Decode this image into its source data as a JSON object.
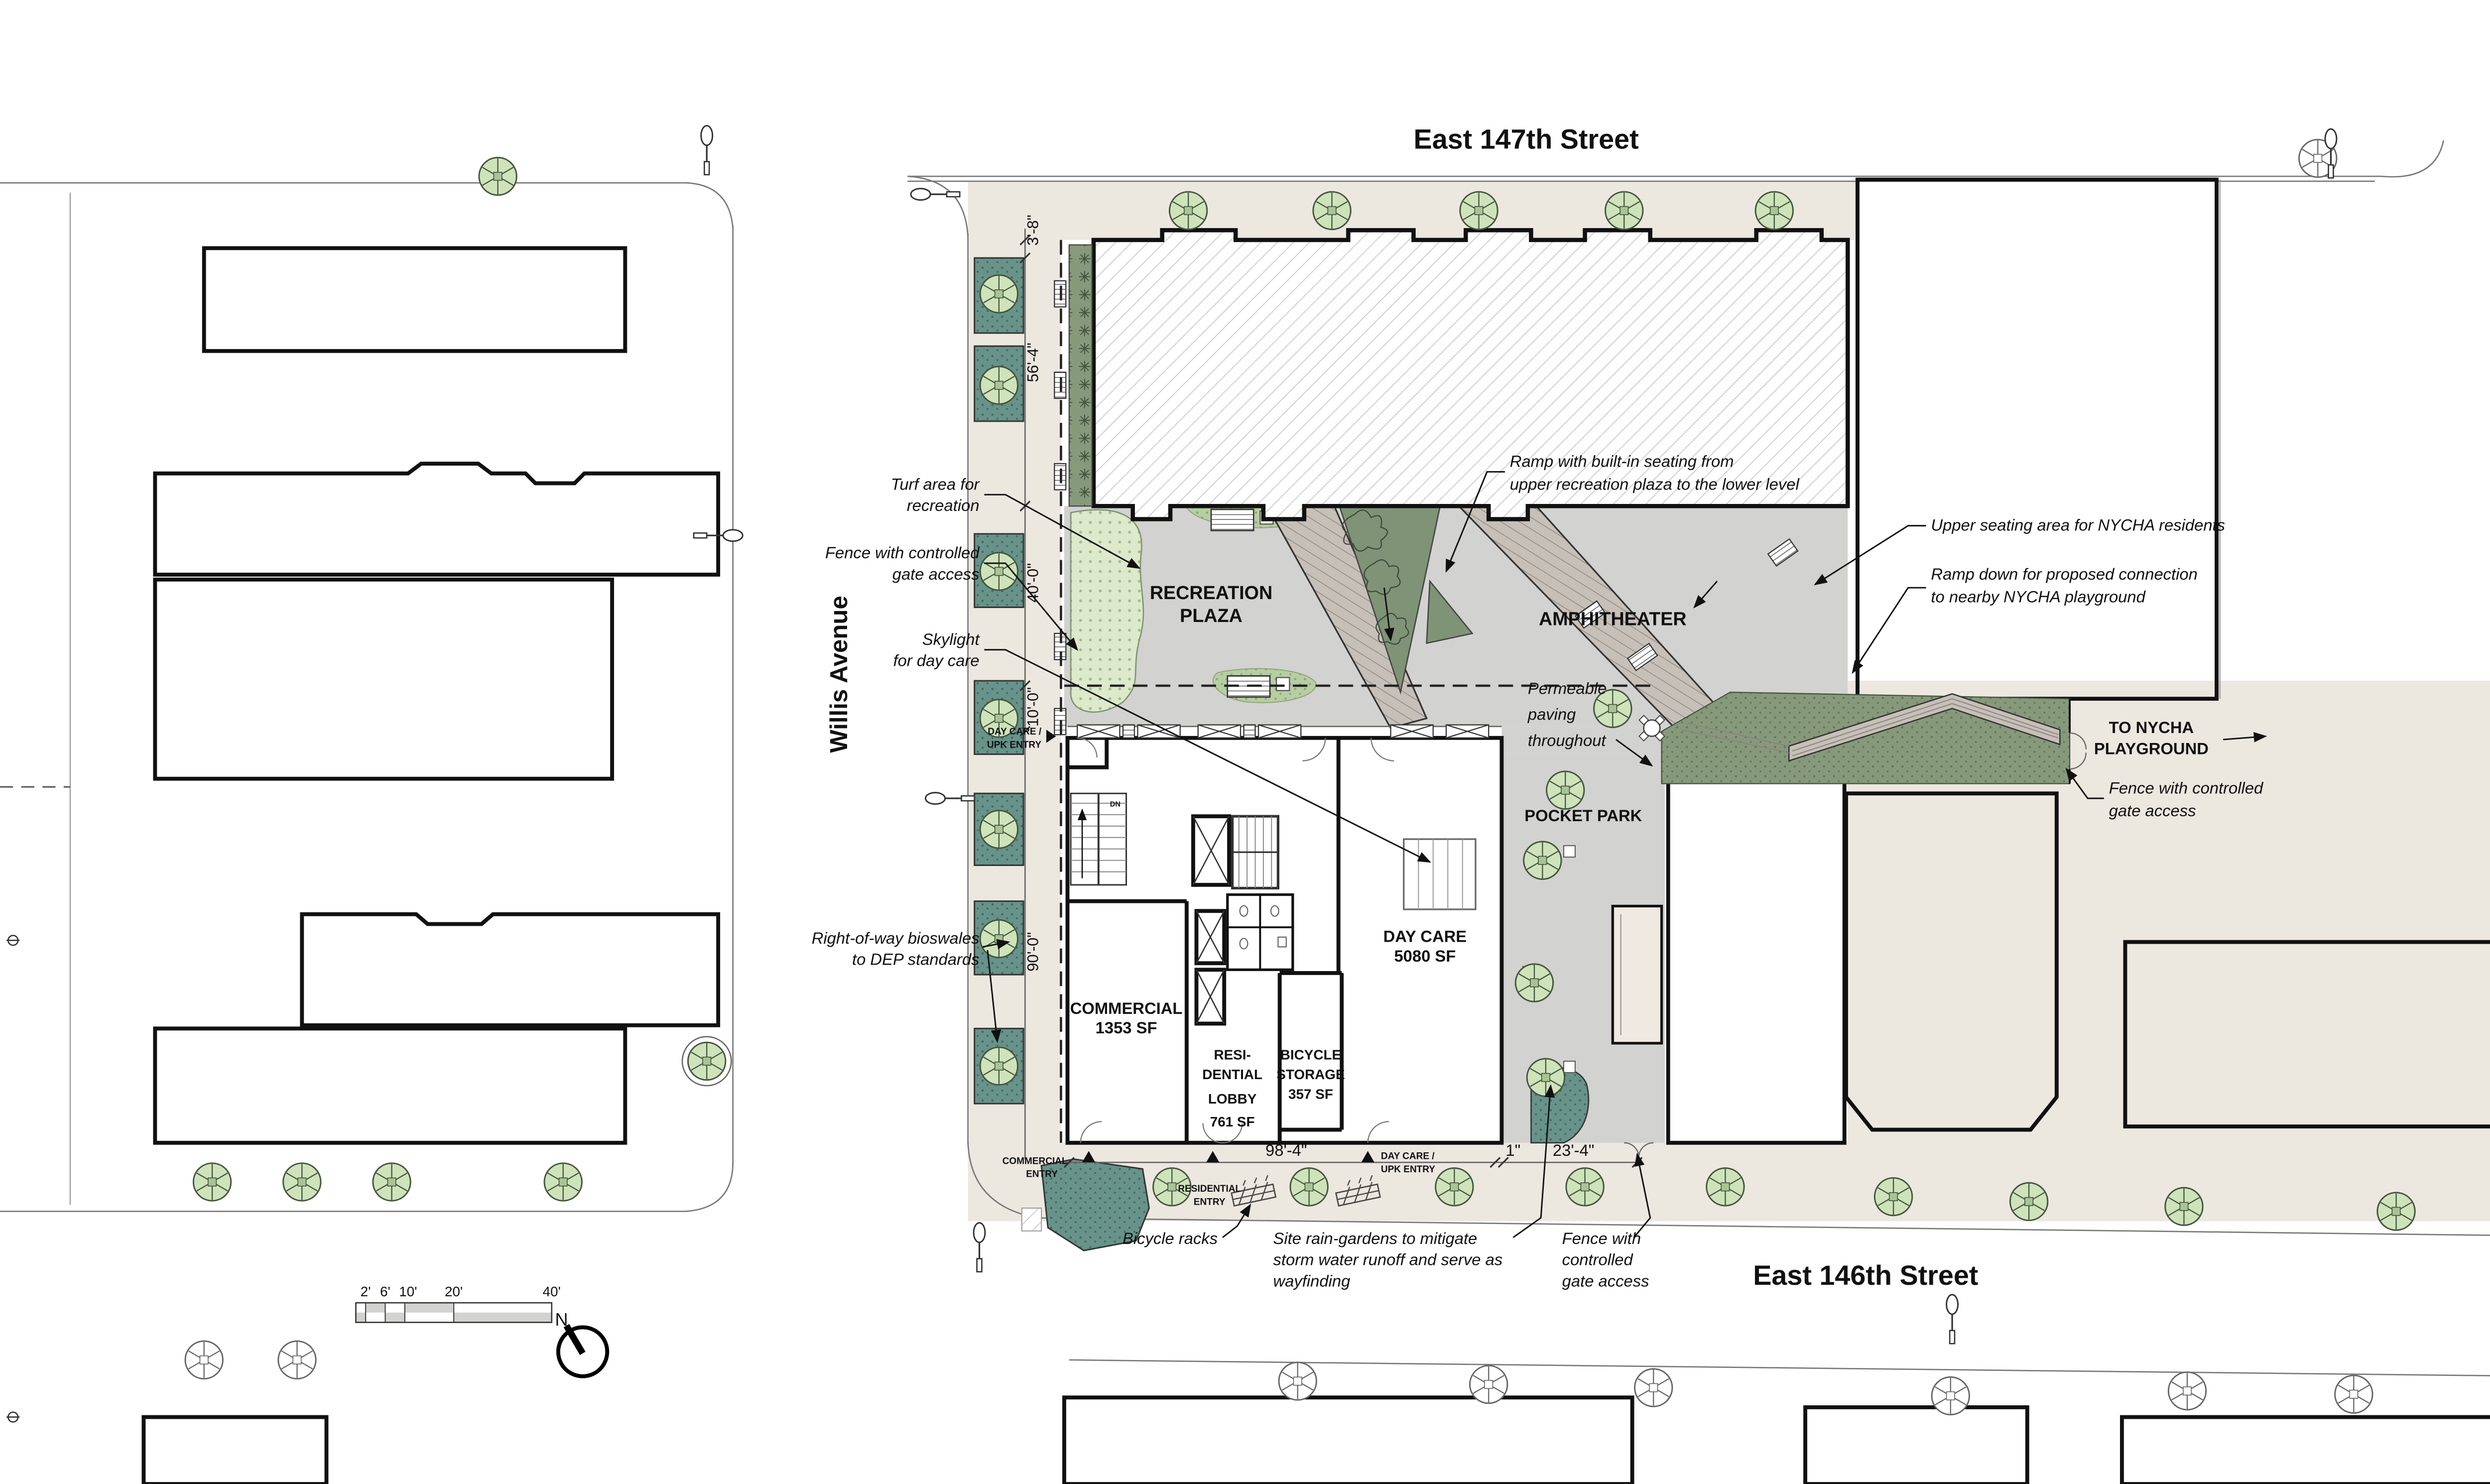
{
  "streets": {
    "top": "East 147th Street",
    "bottom": "East 146th Street",
    "left": "Willis Avenue"
  },
  "zones": {
    "recreation_plaza": [
      "RECREATION",
      "PLAZA"
    ],
    "amphitheater": "AMPHITHEATER",
    "pocket_park": "POCKET PARK",
    "day_care": [
      "DAY CARE",
      "5080 SF"
    ],
    "commercial": [
      "COMMERCIAL",
      "1353 SF"
    ],
    "residential_lobby": [
      "RESI-",
      "DENTIAL",
      "LOBBY",
      "761 SF"
    ],
    "bicycle_storage": [
      "BICYCLE",
      "STORAGE",
      "357 SF"
    ],
    "stair_dn": "DN"
  },
  "annotations": {
    "turf": [
      "Turf area for",
      "recreation"
    ],
    "fence_left": [
      "Fence with controlled",
      "gate access"
    ],
    "skylight": [
      "Skylight",
      "for day care"
    ],
    "bioswales": [
      "Right-of-way bioswales",
      "to DEP standards"
    ],
    "ramp_seating": [
      "Ramp with built-in seating from",
      "upper recreation plaza to the lower level"
    ],
    "upper_seating": "Upper seating area for NYCHA residents",
    "ramp_down": [
      "Ramp down for proposed connection",
      "to nearby NYCHA playground"
    ],
    "to_nycha": [
      "TO NYCHA",
      "PLAYGROUND"
    ],
    "fence_right": [
      "Fence with controlled",
      "gate access"
    ],
    "permeable": [
      "Permeable",
      "paving",
      "throughout"
    ],
    "bicycle_racks": "Bicycle racks",
    "rain_gardens": [
      "Site rain-gardens to mitigate",
      "storm water runoff and serve as",
      "wayfinding"
    ],
    "fence_bottom": [
      "Fence with",
      "controlled",
      "gate access"
    ]
  },
  "entries": {
    "commercial": [
      "COMMERCIAL",
      "ENTRY"
    ],
    "residential": [
      "RESIDENTIAL",
      "ENTRY"
    ],
    "day_care_upk": [
      "DAY CARE /",
      "UPK ENTRY"
    ],
    "day_care_upk_side": [
      "DAY CARE /",
      "UPK ENTRY"
    ]
  },
  "dimensions": {
    "planting": "3'-8\"",
    "building_depth": "56'-4\"",
    "plaza": "40'-0\"",
    "strip": "10'-0\"",
    "ground_floor": "90'-0\"",
    "frontage": "98'-4\"",
    "inch": "1\"",
    "pocket": "23'-4\""
  },
  "scale_bar": {
    "labels": [
      "2'",
      "6'",
      "10'",
      "20'",
      "40'"
    ],
    "north": "N"
  },
  "colors": {
    "sidewalk": "#ece7df",
    "plaza": "#d2d2d0",
    "turf": "#dde9cb",
    "planting_green": "#87997b",
    "bioswale_teal": "#67938a",
    "tree_green": "#cfe3bb",
    "ramp_taupe": "#c7c0b8",
    "hatch_line": "#cbcbcb"
  }
}
